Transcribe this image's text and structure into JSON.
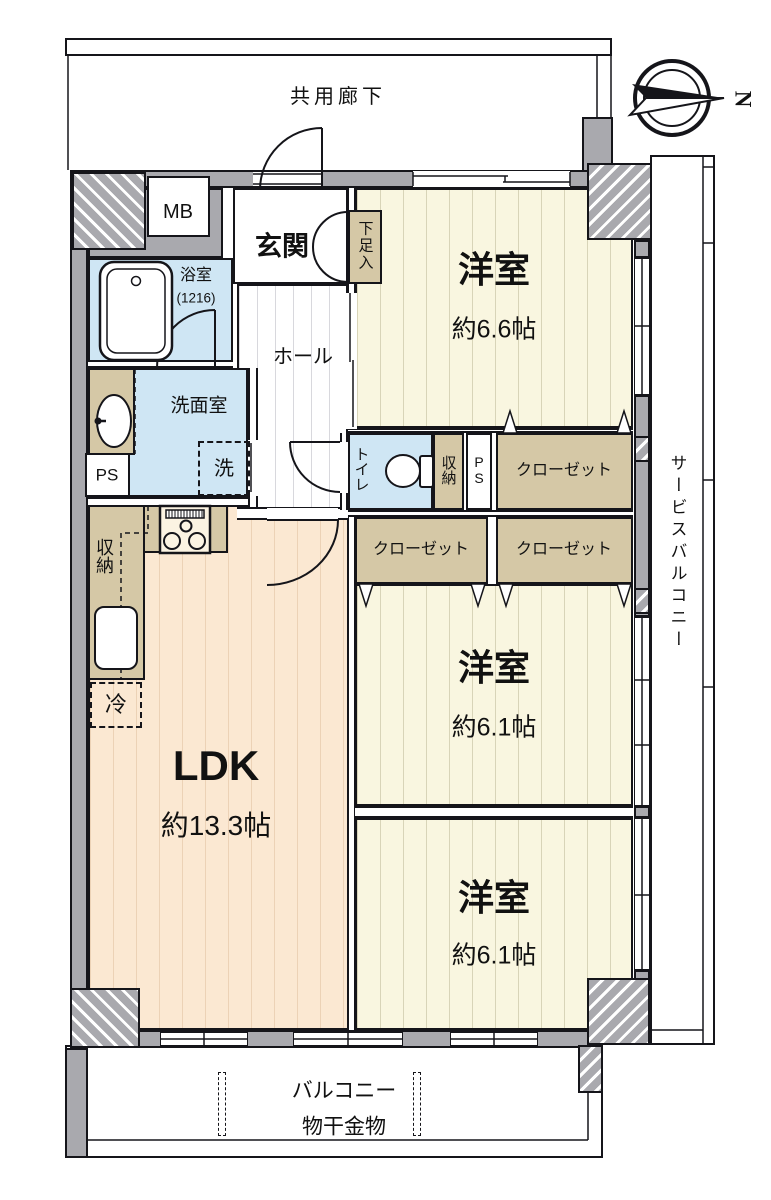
{
  "colors": {
    "wall": "#a9a9ae",
    "outline": "#15151a",
    "bedroom_floor": "#f9f6e0",
    "ldk_floor": "#fbe8d2",
    "wet_area": "#cfe6f4",
    "closet_tan": "#d5c8a6"
  },
  "compass": {
    "north_label": "N"
  },
  "corridor": {
    "label": "共用廊下"
  },
  "service_balcony": {
    "label": "サービスバルコニー"
  },
  "balcony": {
    "label": "バルコニー",
    "hardware_label": "物干金物"
  },
  "rooms": {
    "entrance": {
      "label": "玄関"
    },
    "shoe_box": {
      "label": "下足入"
    },
    "hall": {
      "label": "ホール"
    },
    "bathroom": {
      "label": "浴室",
      "size": "(1216)"
    },
    "washroom": {
      "label": "洗面室"
    },
    "washer": {
      "label": "洗"
    },
    "toilet": {
      "label": "トイレ"
    },
    "storage_mid": {
      "label": "収納"
    },
    "ps_left": {
      "label": "PS"
    },
    "ps_mid": {
      "label": "PS"
    },
    "mb": {
      "label": "MB"
    },
    "closets": [
      "クローゼット",
      "クローゼット",
      "クローゼット"
    ],
    "bedroom_1": {
      "label": "洋室",
      "size": "約6.6帖"
    },
    "bedroom_2": {
      "label": "洋室",
      "size": "約6.1帖"
    },
    "bedroom_3": {
      "label": "洋室",
      "size": "約6.1帖"
    },
    "ldk": {
      "label": "LDK",
      "size": "約13.3帖"
    },
    "kitchen_storage": {
      "label": "収納"
    },
    "fridge": {
      "label": "冷"
    }
  }
}
